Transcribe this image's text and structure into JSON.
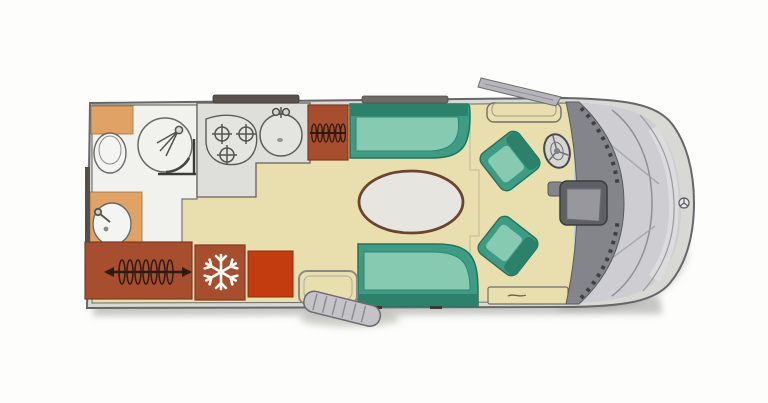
{
  "meta": {
    "title": "Motorhome floor plan (top-down diagram)",
    "view": "plan view, cab at right, rear at left",
    "visible_text": "none"
  },
  "palette": {
    "background": "#fdfdfc",
    "wall_fill": "#d8d8d4",
    "outline": "#67676b",
    "floor_cream": "#e9dfae",
    "wetroom_white": "#f1f1ee",
    "counter_gray": "#dededa",
    "hob_gray": "#e4e4e0",
    "teal": "#3f9c84",
    "teal_light": "#87cab2",
    "teal_dark": "#2b8169",
    "rust": "#a64e2d",
    "bright_red": "#c33c10",
    "orange": "#e0a365",
    "table_top": "#e7e5e0",
    "table_edge": "#6b4430",
    "nose_gray": "#cdcdd2",
    "nose_light": "#dededf",
    "dashboard_gray": "#84848b",
    "console_dark": "#5f5f66",
    "step_gray": "#c4c4c8",
    "window_bar": "#5a524c",
    "icon_dark": "#33190d",
    "icon_white": "#ffffff",
    "fixture_white": "#f4f4f2"
  },
  "zones": {
    "wetroom": "shower and toilet room (rear)",
    "kitchen": "kitchen block with 3-burner hob and round sink",
    "rear_wardrobe": "rear wardrobe with clothes hangers",
    "fridge": "refrigerator with snowflake icon",
    "oven_unit": "red oven / storage unit",
    "front_wardrobe": "small wardrobe with hangers by the dinette",
    "dinette": "lounge with two facing bench sofas and oval table",
    "swivel_chairs": "two swivelled cab captain chairs",
    "entry": "entrance door with fold-out exterior step",
    "cab": "driver cab with steering wheel, dashboard console and windscreen nose"
  },
  "icons": {
    "hangers": "hanger-rail icon",
    "snowflake": "fridge snowflake icon",
    "hob_burners": "three burner rings",
    "sink_faucet": "tap / faucet icon",
    "shower_head": "shower head with spray lines",
    "steering_wheel": "steering wheel",
    "star_emblem": "brand star emblem on front",
    "side_mirror": "side mirror blade",
    "entry_step": "ribbed entry step"
  }
}
